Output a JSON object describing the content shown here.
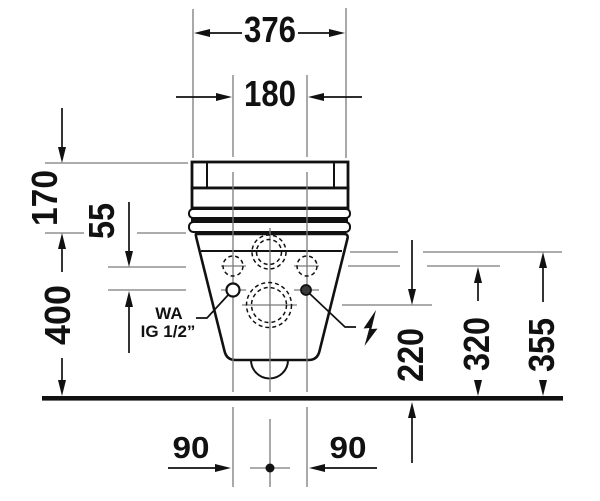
{
  "diagram": {
    "type": "technical-drawing",
    "subject": "wall-hung-toilet-front-elevation",
    "colors": {
      "outline": "#111111",
      "centerline": "#7b7b7b",
      "background": "#ffffff"
    },
    "dimensions": {
      "total_width": "376",
      "bolt_hole_spacing": "180",
      "tank_cover_height": "170",
      "hole_to_connection_offset": "55",
      "rim_height": "400",
      "outlet_center_height": "220",
      "fixing_hole_height": "320",
      "water_supply_height": "355",
      "left_hole_offset": "90",
      "right_hole_offset": "90"
    },
    "labels": {
      "water_connection_line1": "WA",
      "water_connection_line2": "IG 1/2”",
      "electrical_connection_icon": "lightning-bolt"
    }
  }
}
